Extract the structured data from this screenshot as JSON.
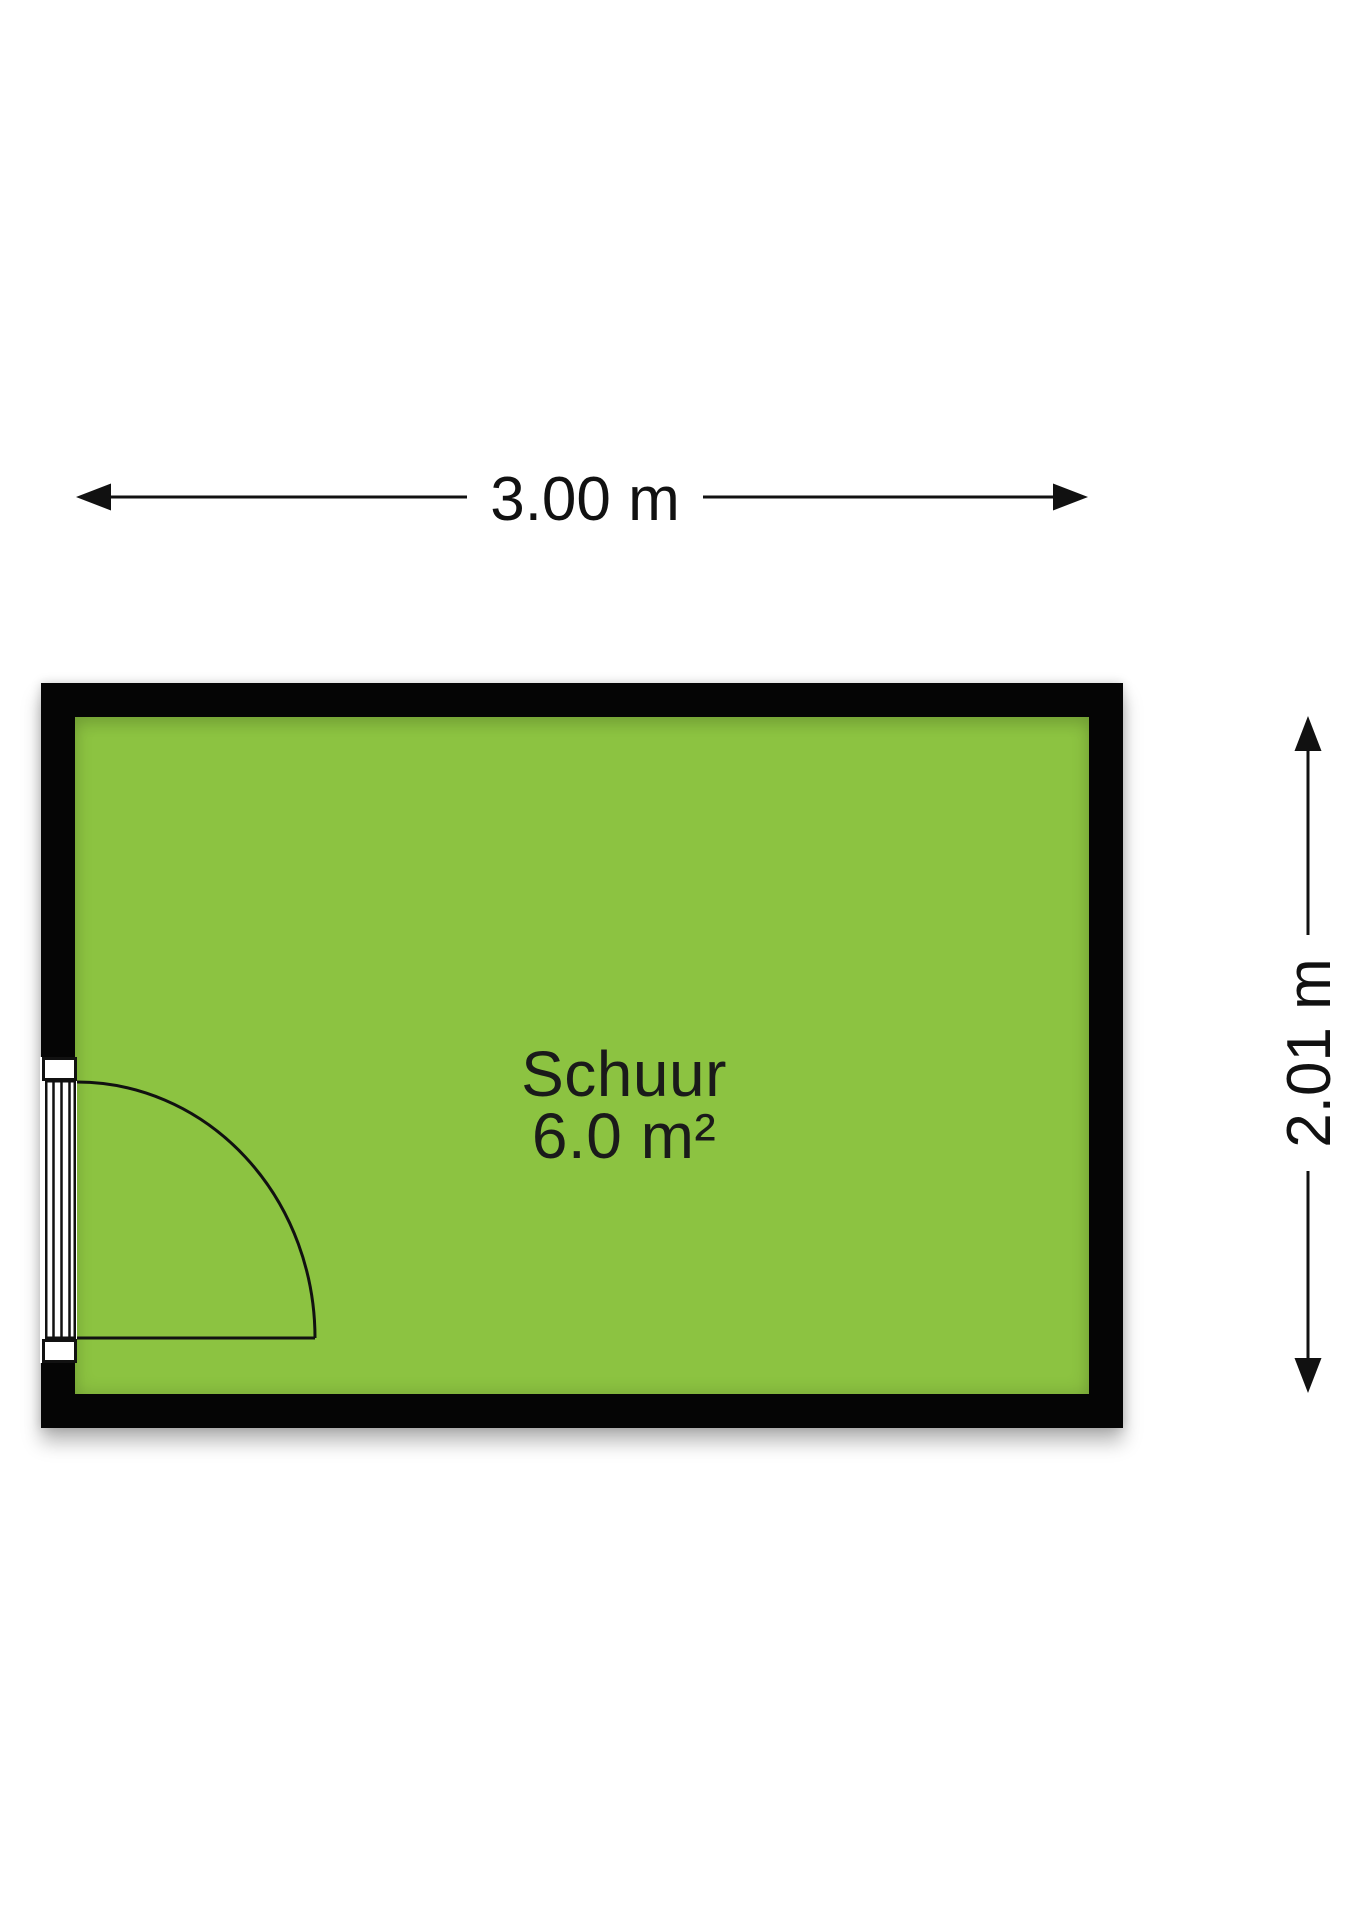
{
  "room": {
    "name": "Schuur",
    "area_label": "6.0 m²"
  },
  "dimensions": {
    "width_label": "3.00 m",
    "height_label": "2.01 m"
  },
  "colors": {
    "background": "#FFFFFF",
    "wall": "#050505",
    "floor_fill": "#8CC341",
    "dimension_ink": "#111111",
    "label_ink": "#1A1A1A"
  }
}
